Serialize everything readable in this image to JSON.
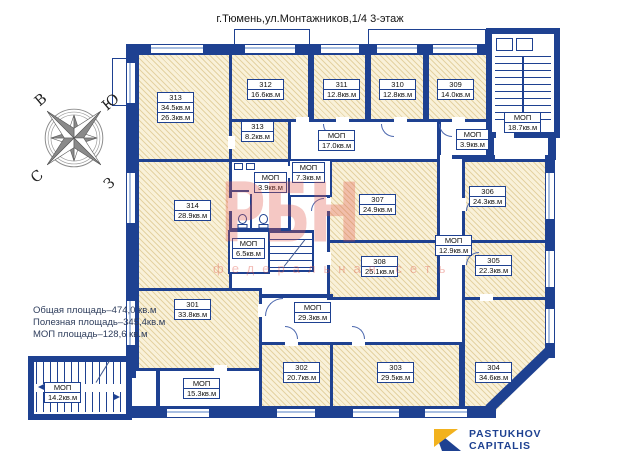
{
  "title": "г.Тюмень,ул.Монтажников,1/4  3-этаж",
  "summary": {
    "total": "Общая площадь–474,0 кв.м",
    "useful": "Полезная площадь–345,4кв.м",
    "mop": "МОП площадь–128,6 кв.м"
  },
  "watermark": {
    "text": "РБН",
    "subtext": "федеральная сеть"
  },
  "logo": {
    "line1": "PASTUKHOV",
    "line2": "CAPITALIS"
  },
  "compass": {
    "n": "С",
    "s": "Ю",
    "e": "В",
    "w": "З"
  },
  "mop_label": "МОП",
  "mop_areas": [
    "17.0кв.м",
    "18.7кв.м",
    "3.9кв.м",
    "7.3кв.м",
    "3.9кв.м",
    "6.5кв.м",
    "12.9кв.м",
    "29.3кв.м",
    "15.3кв.м",
    "14.2кв.м"
  ],
  "rooms": [
    {
      "number": "313",
      "area": "34.5кв.м",
      "area2": "26.3кв.м"
    },
    {
      "number": "312",
      "area": "16.6кв.м"
    },
    {
      "number": "311",
      "area": "12.8кв.м"
    },
    {
      "number": "310",
      "area": "12.8кв.м"
    },
    {
      "number": "309",
      "area": "14.0кв.м"
    },
    {
      "number": "313",
      "area": "8.2кв.м"
    },
    {
      "number": "314",
      "area": "28.9кв.м"
    },
    {
      "number": "307",
      "area": "24.9кв.м"
    },
    {
      "number": "308",
      "area": "25.1кв.м"
    },
    {
      "number": "306",
      "area": "24.3кв.м"
    },
    {
      "number": "305",
      "area": "22.3кв.м"
    },
    {
      "number": "304",
      "area": "34.6кв.м"
    },
    {
      "number": "303",
      "area": "29.5кв.м"
    },
    {
      "number": "302",
      "area": "20.7кв.м"
    },
    {
      "number": "301",
      "area": "33.8кв.м"
    }
  ],
  "colors": {
    "wall": "#1e4191",
    "room_fill": "#f9f1d9",
    "hatch_line": "#e4d2a2",
    "window_glass": "#a9bfe2",
    "watermark": "#e05548",
    "logo_navy": "#1e4191",
    "logo_yellow": "#f2b21e"
  }
}
